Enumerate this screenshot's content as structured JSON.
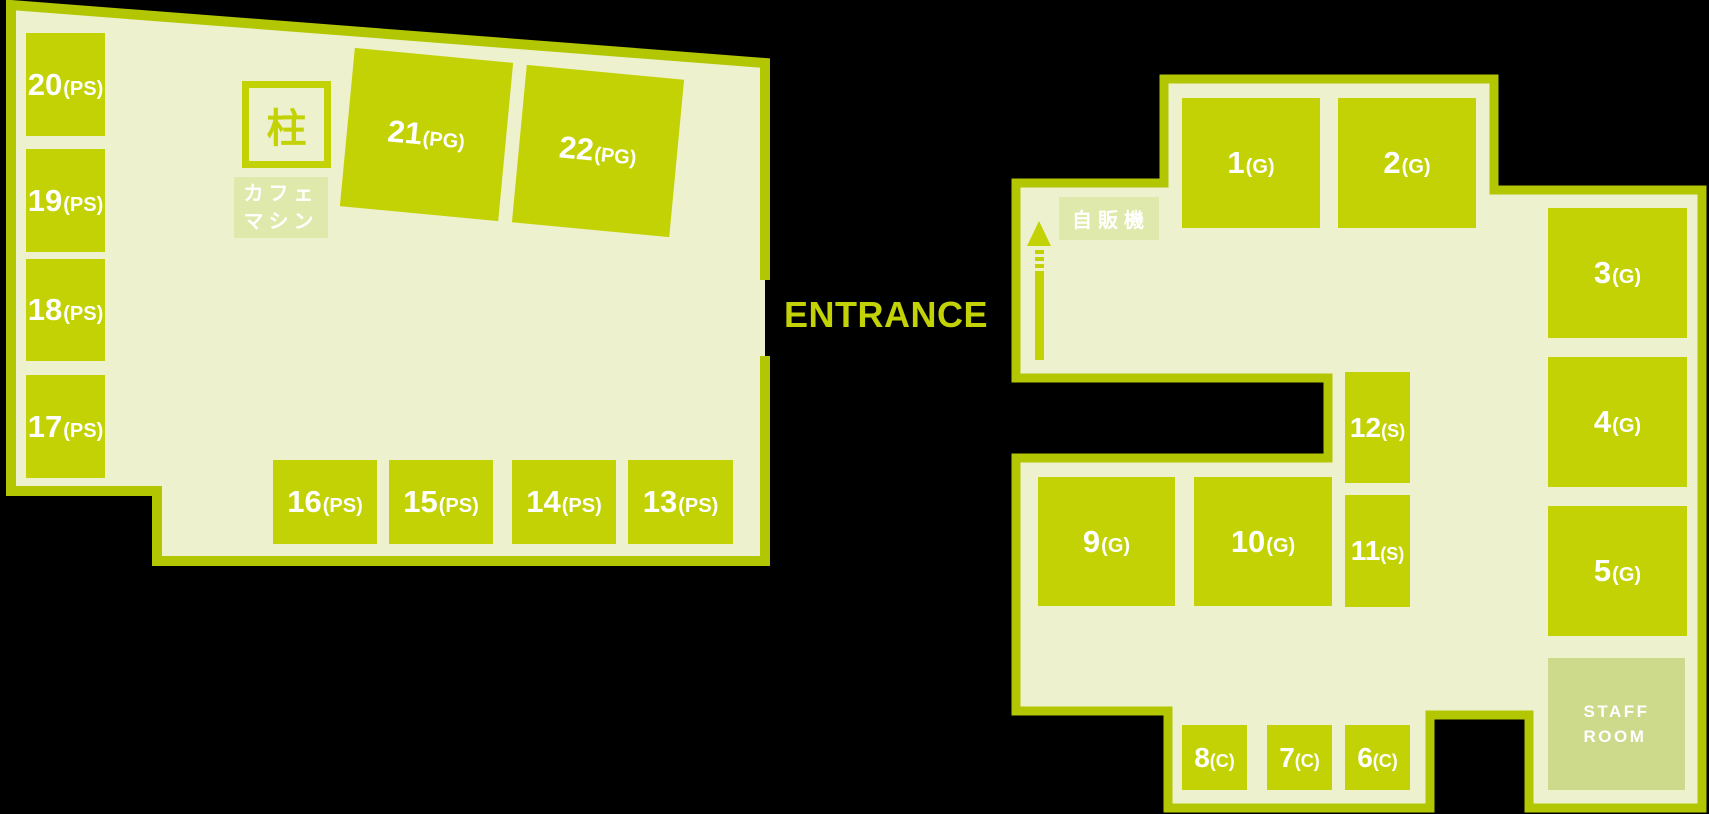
{
  "labels": {
    "entrance": "ENTRANCE"
  },
  "left_section": {
    "pillar_label": "柱",
    "cafe_machine_lines": [
      "カフェ",
      "マシン"
    ],
    "booths": [
      {
        "number": "20",
        "type": "(PS)"
      },
      {
        "number": "19",
        "type": "(PS)"
      },
      {
        "number": "18",
        "type": "(PS)"
      },
      {
        "number": "17",
        "type": "(PS)"
      },
      {
        "number": "21",
        "type": "(PG)"
      },
      {
        "number": "22",
        "type": "(PG)"
      },
      {
        "number": "16",
        "type": "(PS)"
      },
      {
        "number": "15",
        "type": "(PS)"
      },
      {
        "number": "14",
        "type": "(PS)"
      },
      {
        "number": "13",
        "type": "(PS)"
      }
    ]
  },
  "right_section": {
    "vending_machine_label": "自販機",
    "staff_room_lines": [
      "STAFF",
      "ROOM"
    ],
    "booths": [
      {
        "number": "1",
        "type": "(G)"
      },
      {
        "number": "2",
        "type": "(G)"
      },
      {
        "number": "3",
        "type": "(G)"
      },
      {
        "number": "4",
        "type": "(G)"
      },
      {
        "number": "5",
        "type": "(G)"
      },
      {
        "number": "9",
        "type": "(G)"
      },
      {
        "number": "10",
        "type": "(G)"
      },
      {
        "number": "12",
        "type": "(S)"
      },
      {
        "number": "11",
        "type": "(S)"
      },
      {
        "number": "8",
        "type": "(C)"
      },
      {
        "number": "7",
        "type": "(C)"
      },
      {
        "number": "6",
        "type": "(C)"
      }
    ]
  },
  "colors": {
    "booth_green": "#c3d204",
    "wall_green": "#b2c602",
    "floor": "#edf1cd",
    "equipment_bg": "#e0e9ac",
    "staff_room_bg": "#cdd98b",
    "text_white": "#ffffff",
    "entrance_text": "#c3d204",
    "background": "#000000"
  }
}
